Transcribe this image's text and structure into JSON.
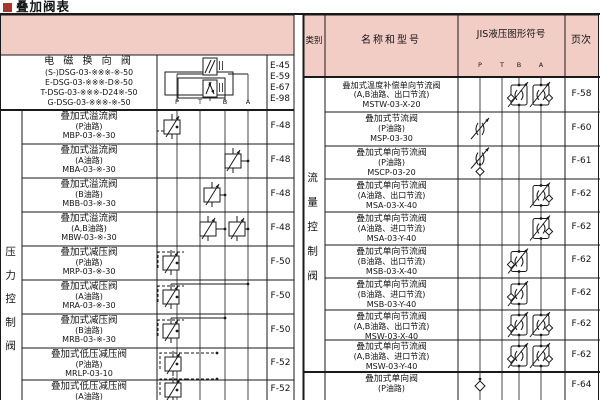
{
  "page": {
    "title": "叠加阀表"
  },
  "colors": {
    "band_pink": "#f2cdc6",
    "title_red": "#a8342a",
    "line": "#1a1a1a"
  },
  "left_table": {
    "category_label": "压力控制阀",
    "port_labels": [
      "P",
      "T",
      "B",
      "A"
    ],
    "row1": {
      "name": "电 磁 换 向 阀",
      "models": [
        "(S-)DSG-03-※※※-※-50",
        "E-DSG-03-※※※-D※-50",
        "T-DSG-03-※※※-D24※-50",
        "G-DSG-03-※※※-※-50"
      ],
      "pages": [
        "E-45",
        "E-59",
        "E-67",
        "E-98"
      ],
      "symbol": "solenoid-directional-valve"
    },
    "rows": [
      {
        "name": "叠加式溢流阀",
        "circuit": "(P油路)",
        "model": "MBP-03-※-30",
        "page": "F-48",
        "symbols": [
          {
            "type": "relief",
            "port": "P"
          }
        ]
      },
      {
        "name": "叠加式溢流阀",
        "circuit": "(A油路)",
        "model": "MBA-03-※-30",
        "page": "F-48",
        "symbols": [
          {
            "type": "relief",
            "port": "A"
          }
        ]
      },
      {
        "name": "叠加式溢流阀",
        "circuit": "(B油路)",
        "model": "MBB-03-※-30",
        "page": "F-48",
        "symbols": [
          {
            "type": "relief",
            "port": "B"
          }
        ]
      },
      {
        "name": "叠加式溢流阀",
        "circuit": "(A,B油路)",
        "model": "MBW-03-※-30",
        "page": "F-48",
        "symbols": [
          {
            "type": "relief",
            "port": "B"
          },
          {
            "type": "relief",
            "port": "A"
          }
        ]
      },
      {
        "name": "叠加式减压阀",
        "circuit": "(P油路)",
        "model": "MRP-03-※-30",
        "page": "F-50",
        "symbols": [
          {
            "type": "reducing",
            "port": "P"
          }
        ]
      },
      {
        "name": "叠加式减压阀",
        "circuit": "(A油路)",
        "model": "MRA-03-※-30",
        "page": "F-50",
        "symbols": [
          {
            "type": "reducing",
            "port": "P",
            "link": "A"
          }
        ]
      },
      {
        "name": "叠加式减压阀",
        "circuit": "(B油路)",
        "model": "MRB-03-※-30",
        "page": "F-50",
        "symbols": [
          {
            "type": "reducing",
            "port": "P",
            "link": "B"
          }
        ]
      },
      {
        "name": "叠加式低压减压阀",
        "circuit": "(P油路)",
        "model": "MRLP-03-10",
        "page": "F-52",
        "symbols": [
          {
            "type": "reducing",
            "port": "P",
            "pilot": true
          }
        ]
      },
      {
        "name": "叠加式低压减压阀",
        "circuit": "(A油路)",
        "model": "",
        "page": "F-52",
        "symbols": [
          {
            "type": "reducing",
            "port": "P",
            "pilot": true
          }
        ]
      }
    ]
  },
  "right_table": {
    "headers": {
      "category": "类别",
      "name": "名称和型号",
      "symbol": "JIS液压图形符号",
      "page": "页次"
    },
    "port_labels": [
      "P",
      "T",
      "B",
      "A"
    ],
    "category_label": "流量控制阀",
    "rows": [
      {
        "name": "叠加式温度补偿单向节流阀",
        "circuit": "(A,B油路、出口节流)",
        "model": "MSTW-03-X-20",
        "page": "F-58",
        "symbols": [
          {
            "type": "check-throttle",
            "port": "B"
          },
          {
            "type": "check-throttle",
            "port": "A"
          }
        ]
      },
      {
        "name": "叠加式节流阀",
        "circuit": "(P油路)",
        "model": "MSP-03-30",
        "page": "F-60",
        "symbols": [
          {
            "type": "throttle",
            "port": "P"
          }
        ]
      },
      {
        "name": "叠加式单向节流阀",
        "circuit": "(P油路)",
        "model": "MSCP-03-20",
        "page": "F-61",
        "symbols": [
          {
            "type": "throttle-check",
            "port": "P"
          }
        ]
      },
      {
        "name": "叠加式单向节流阀",
        "circuit": "(A油路、出口节流)",
        "model": "MSA-03-X-40",
        "page": "F-62",
        "symbols": [
          {
            "type": "check-throttle",
            "port": "A"
          }
        ]
      },
      {
        "name": "叠加式单向节流阀",
        "circuit": "(A油路、进口节流)",
        "model": "MSA-03-Y-40",
        "page": "F-62",
        "symbols": [
          {
            "type": "check-throttle",
            "port": "A"
          }
        ]
      },
      {
        "name": "叠加式单向节流阀",
        "circuit": "(B油路、出口节流)",
        "model": "MSB-03-X-40",
        "page": "F-62",
        "symbols": [
          {
            "type": "check-throttle",
            "port": "B"
          }
        ]
      },
      {
        "name": "叠加式单向节流阀",
        "circuit": "(B油路、进口节流)",
        "model": "MSB-03-Y-40",
        "page": "F-62",
        "symbols": [
          {
            "type": "check-throttle",
            "port": "B"
          }
        ]
      },
      {
        "name": "叠加式单向节流阀",
        "circuit": "(A,B油路、出口节流)",
        "model": "MSW-03-X-40",
        "page": "F-62",
        "symbols": [
          {
            "type": "check-throttle",
            "port": "B"
          },
          {
            "type": "check-throttle",
            "port": "A"
          }
        ]
      },
      {
        "name": "叠加式单向节流阀",
        "circuit": "(A,B油路、进口节流)",
        "model": "MSW-03-Y-40",
        "page": "F-62",
        "symbols": [
          {
            "type": "check-throttle",
            "port": "B"
          },
          {
            "type": "check-throttle",
            "port": "A"
          }
        ]
      },
      {
        "name": "叠加式单向阀",
        "circuit": "(P油路)",
        "model": "",
        "page": "F-64",
        "symbols": [
          {
            "type": "check",
            "port": "P"
          }
        ]
      }
    ]
  }
}
